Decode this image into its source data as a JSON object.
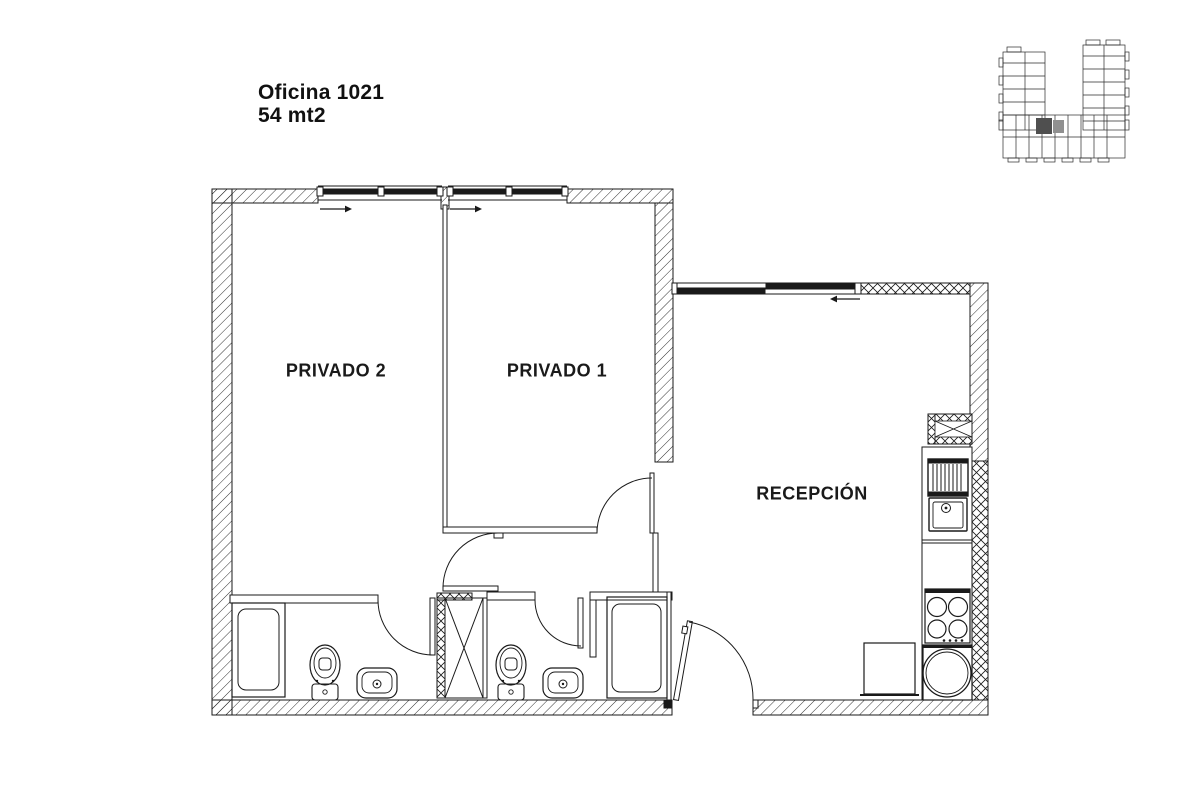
{
  "title": {
    "line1": "Oficina 1021",
    "line2": "54 mt2"
  },
  "rooms": [
    {
      "id": "privado-2",
      "label": "PRIVADO 2"
    },
    {
      "id": "privado-1",
      "label": "PRIVADO 1"
    },
    {
      "id": "recepcion",
      "label": "RECEPCIÓN"
    }
  ],
  "colors": {
    "line": "#1a1a1a",
    "background": "#ffffff",
    "highlight_unit_primary": "#4f4f4f",
    "highlight_unit_secondary": "#909090"
  }
}
